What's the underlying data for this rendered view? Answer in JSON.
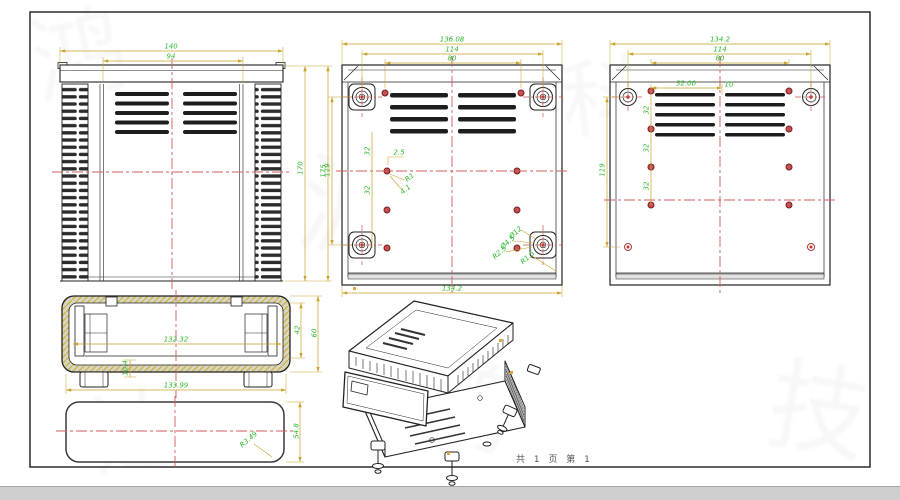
{
  "meta": {
    "sheet_note": "共 1 页  第 1"
  },
  "colors": {
    "dimension_line": "#c9a227",
    "dimension_text": "#2eb82e",
    "centerline": "#d25b5b",
    "body_line": "#222222",
    "hole_red": "#c0392b",
    "hatch_yellow": "#c9b64f"
  },
  "annotations": [
    {
      "t": "140",
      "x": 171,
      "y": 47,
      "r": 0
    },
    {
      "t": "94",
      "x": 171,
      "y": 57,
      "r": 0
    },
    {
      "t": "170",
      "x": 301,
      "y": 168,
      "r": -90
    },
    {
      "t": "175",
      "x": 324,
      "y": 171,
      "r": -90
    },
    {
      "t": "136.08",
      "x": 452,
      "y": 40,
      "r": 0
    },
    {
      "t": "114",
      "x": 452,
      "y": 50,
      "r": 0
    },
    {
      "t": "80",
      "x": 452,
      "y": 59,
      "r": 0
    },
    {
      "t": "119",
      "x": 328,
      "y": 170,
      "r": -90
    },
    {
      "t": "134.2",
      "x": 452,
      "y": 289,
      "r": 0
    },
    {
      "t": "32",
      "x": 368,
      "y": 151,
      "r": -90
    },
    {
      "t": "32",
      "x": 368,
      "y": 190,
      "r": -90
    },
    {
      "t": "2.5",
      "x": 399,
      "y": 153,
      "r": 0
    },
    {
      "t": "R1",
      "x": 410,
      "y": 178,
      "r": -38
    },
    {
      "t": "4.1",
      "x": 406,
      "y": 190,
      "r": -38
    },
    {
      "t": "Ø12",
      "x": 516,
      "y": 233,
      "r": -42
    },
    {
      "t": "Ø4.5",
      "x": 508,
      "y": 243,
      "r": -42
    },
    {
      "t": "R2.5",
      "x": 500,
      "y": 253,
      "r": -42
    },
    {
      "t": "R1.5",
      "x": 528,
      "y": 258,
      "r": -42
    },
    {
      "t": "134.2",
      "x": 720,
      "y": 40,
      "r": 0
    },
    {
      "t": "114",
      "x": 720,
      "y": 50,
      "r": 0
    },
    {
      "t": "80",
      "x": 720,
      "y": 59,
      "r": 0
    },
    {
      "t": "32.00",
      "x": 686,
      "y": 84,
      "r": 0
    },
    {
      "t": "10",
      "x": 729,
      "y": 85,
      "r": 0
    },
    {
      "t": "119",
      "x": 603,
      "y": 170,
      "r": -90
    },
    {
      "t": "32",
      "x": 647,
      "y": 110,
      "r": -90
    },
    {
      "t": "32",
      "x": 647,
      "y": 148,
      "r": -90
    },
    {
      "t": "32",
      "x": 647,
      "y": 186,
      "r": -90
    },
    {
      "t": "132.32",
      "x": 176,
      "y": 340,
      "r": 0
    },
    {
      "t": "133.99",
      "x": 176,
      "y": 386,
      "r": 0
    },
    {
      "t": "42",
      "x": 298,
      "y": 330,
      "r": -90
    },
    {
      "t": "60",
      "x": 315,
      "y": 333,
      "r": -90
    },
    {
      "t": "10.4",
      "x": 126,
      "y": 368,
      "r": -90
    },
    {
      "t": "54.8",
      "x": 297,
      "y": 431,
      "r": -90
    },
    {
      "t": "R3.49",
      "x": 249,
      "y": 440,
      "r": -40
    }
  ],
  "watermarks": [
    {
      "g": "鸿",
      "x": 30,
      "y": -20,
      "s": 95,
      "r": -12
    },
    {
      "g": "源",
      "x": 300,
      "y": 120,
      "s": 110,
      "r": 8
    },
    {
      "g": "科",
      "x": 560,
      "y": 30,
      "s": 85,
      "r": -6
    },
    {
      "g": "技",
      "x": 770,
      "y": 330,
      "s": 100,
      "r": 10
    },
    {
      "g": "达",
      "x": 90,
      "y": 360,
      "s": 90,
      "r": -8
    },
    {
      "g": "鸿",
      "x": 420,
      "y": 330,
      "s": 95,
      "r": 14
    },
    {
      "g": "源",
      "x": 700,
      "y": 150,
      "s": 80,
      "r": -10
    }
  ]
}
